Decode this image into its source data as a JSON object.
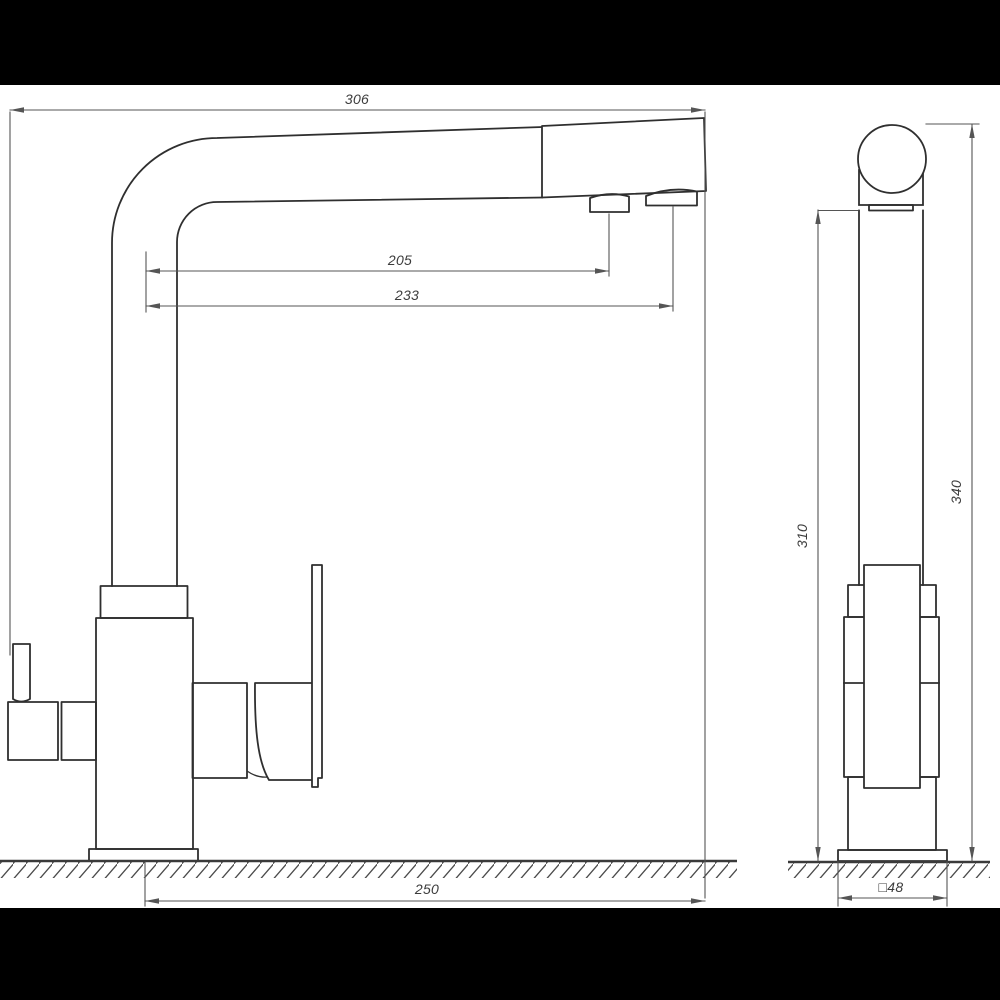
{
  "drawing": {
    "colors": {
      "outline": "#2f2f2f",
      "dimension_line": "#555555",
      "dimension_text": "#3c3c3c",
      "ground": "#3a3a3a",
      "background": "#ffffff",
      "letterbox": "#000000"
    },
    "dims": {
      "d306": {
        "label": "306"
      },
      "d205": {
        "label": "205"
      },
      "d233": {
        "label": "233"
      },
      "d250": {
        "label": "250"
      },
      "d310": {
        "label": "310"
      },
      "d340": {
        "label": "340"
      },
      "d48": {
        "label": "□48"
      }
    }
  }
}
